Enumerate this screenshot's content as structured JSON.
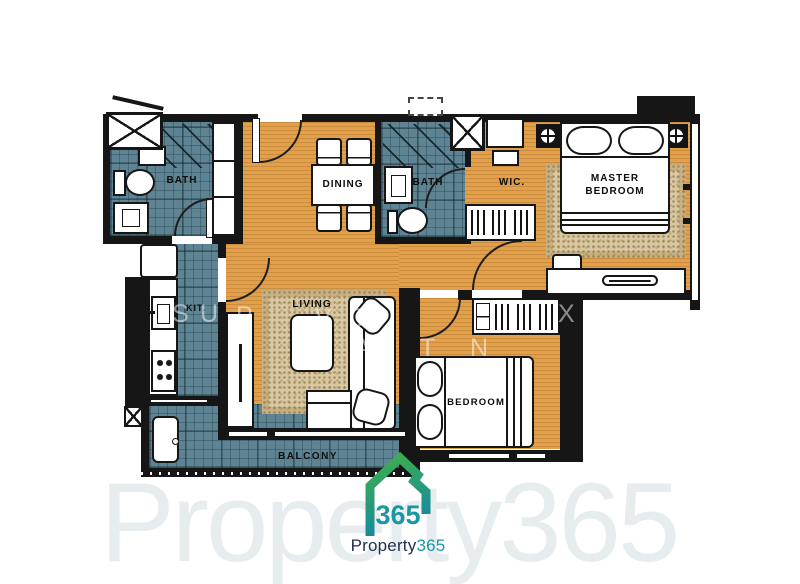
{
  "plan": {
    "room_labels": {
      "bath_1": "BATH",
      "dining": "DINING",
      "bath_2": "BATH",
      "walk_in_closet": "WIC.",
      "master_bedroom": "MASTER BEDROOM",
      "kitchen": "KIT.",
      "living": "LIVING",
      "bedroom_2": "BEDROOM",
      "balcony": "BALCONY"
    },
    "colors": {
      "wood_floor": "#e2a04b",
      "tile_floor": "#5e8493",
      "wall": "#161616",
      "rug": "#d8c7a0"
    }
  },
  "watermark": {
    "large_text": "Property365",
    "scatter_letters": [
      "S",
      "U",
      "P",
      "V",
      "T",
      "X",
      ")",
      "I",
      "A",
      "T",
      "N"
    ]
  },
  "logo": {
    "icon_text": "365",
    "name_prefix": "Property",
    "name_suffix": "365",
    "colors": {
      "green": "#3fb04b",
      "teal": "#1689a0",
      "navy": "#223150"
    }
  }
}
